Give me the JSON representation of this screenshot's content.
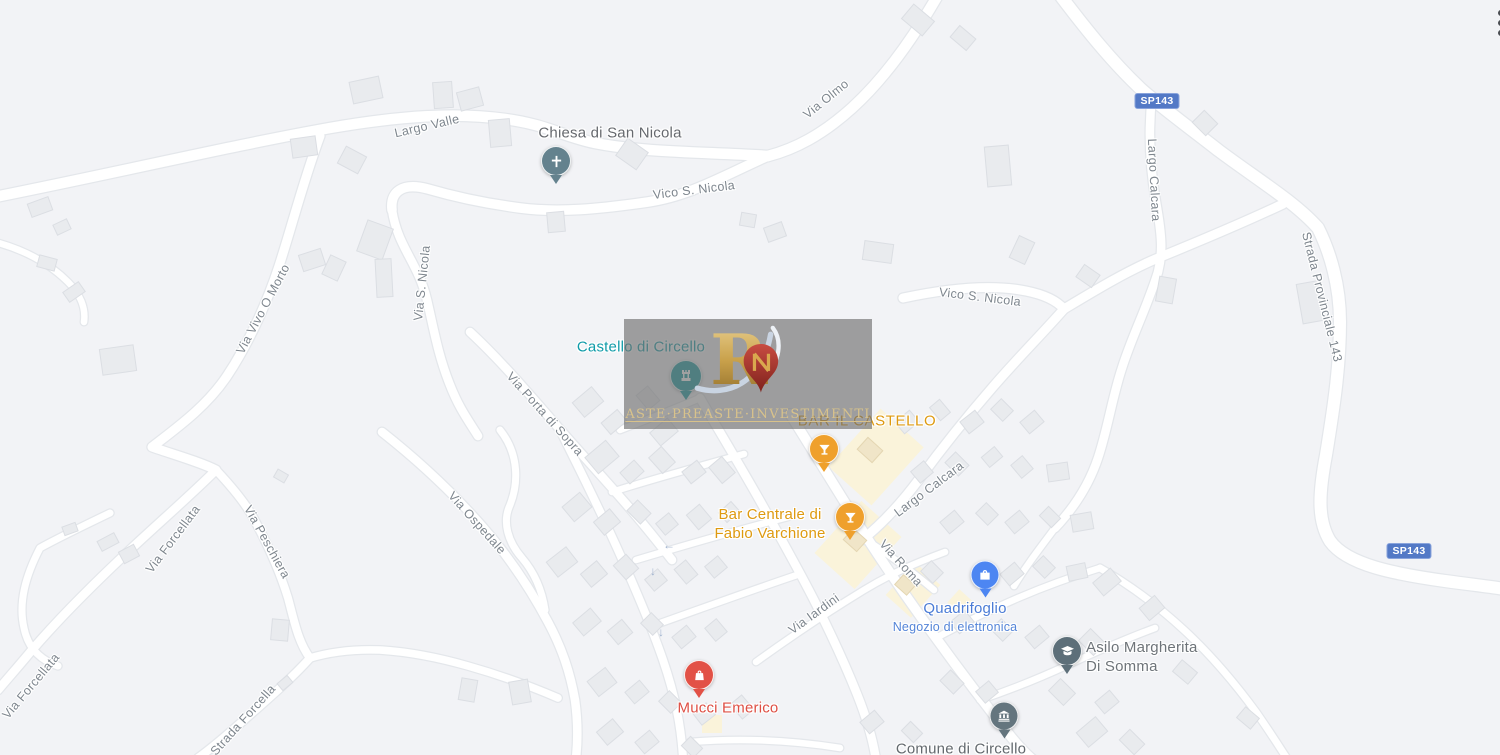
{
  "menu": {
    "more_options_icon": "kebab-vertical-dots"
  },
  "watermark": {
    "logo_letter": "R",
    "tagline": "ASTE·PREASTE·INVESTIMENTI"
  },
  "shields": [
    {
      "label": "SP143"
    },
    {
      "label": "SP143"
    }
  ],
  "pois": [
    {
      "label": "Chiesa di San Nicola",
      "icon": "church-cross",
      "pin_color": "#64828E",
      "label_color": "#66696E"
    },
    {
      "label": "Castello di Circello",
      "icon": "castle",
      "pin_color": "#13989F",
      "label_color": "#0F9BA8"
    },
    {
      "label": "BAR IL CASTELLO",
      "icon": "cocktail-glass",
      "pin_color": "#EFA02C",
      "label_color": "#DE9A10"
    },
    {
      "label_line1": "Bar Centrale di",
      "label_line2": "Fabio Varchione",
      "icon": "cocktail-glass",
      "pin_color": "#EFA02C",
      "label_color": "#DE9A10"
    },
    {
      "label": "Quadrifoglio",
      "subtitle": "Negozio di elettronica",
      "icon": "shopping-bag",
      "pin_color": "#4D86F2",
      "label_color": "#4B7CD6"
    },
    {
      "label_line1": "Asilo Margherita",
      "label_line2": "Di Somma",
      "icon": "graduation-cap",
      "pin_color": "#5D6F79",
      "label_color": "#6E7479"
    },
    {
      "label": "Mucci Emerico",
      "icon": "shopping-store",
      "pin_color": "#E25146",
      "label_color": "#DE4F44"
    },
    {
      "label": "Comune di Circello",
      "icon": "government-building",
      "pin_color": "#64757E",
      "label_color": "#63696E"
    }
  ],
  "roads": [
    {
      "text": "Largo Valle"
    },
    {
      "text": "Vico S. Nicola"
    },
    {
      "text": "Via Olmo"
    },
    {
      "text": "Largo Calcara"
    },
    {
      "text": "Strada Provinciale 143"
    },
    {
      "text": "Vico S. Nicola"
    },
    {
      "text": "Via Vivo O Morto"
    },
    {
      "text": "Via S. Nicola"
    },
    {
      "text": "Via Porta di Sopra"
    },
    {
      "text": "Via Ospedale"
    },
    {
      "text": "Via Forcellata"
    },
    {
      "text": "Via Peschiera"
    },
    {
      "text": "Via Forcellata"
    },
    {
      "text": "Strada Forcella"
    },
    {
      "text": "Largo Calcara"
    },
    {
      "text": "Via Roma"
    },
    {
      "text": "Via Iardini"
    }
  ],
  "colors": {
    "land": "#F2F3F6",
    "road_fill": "#FFFFFF",
    "road_casing": "#E4E7EB",
    "building": "#E9EBEE",
    "building_border": "#DBDEE3",
    "commercial_area": "#FAF3DA",
    "road_label": "#7E868E",
    "route_shield": "#5379C6",
    "watermark_panel": "#707070",
    "watermark_gold": "#D8C28B",
    "oneway_arrow": "#9FB2CE"
  }
}
